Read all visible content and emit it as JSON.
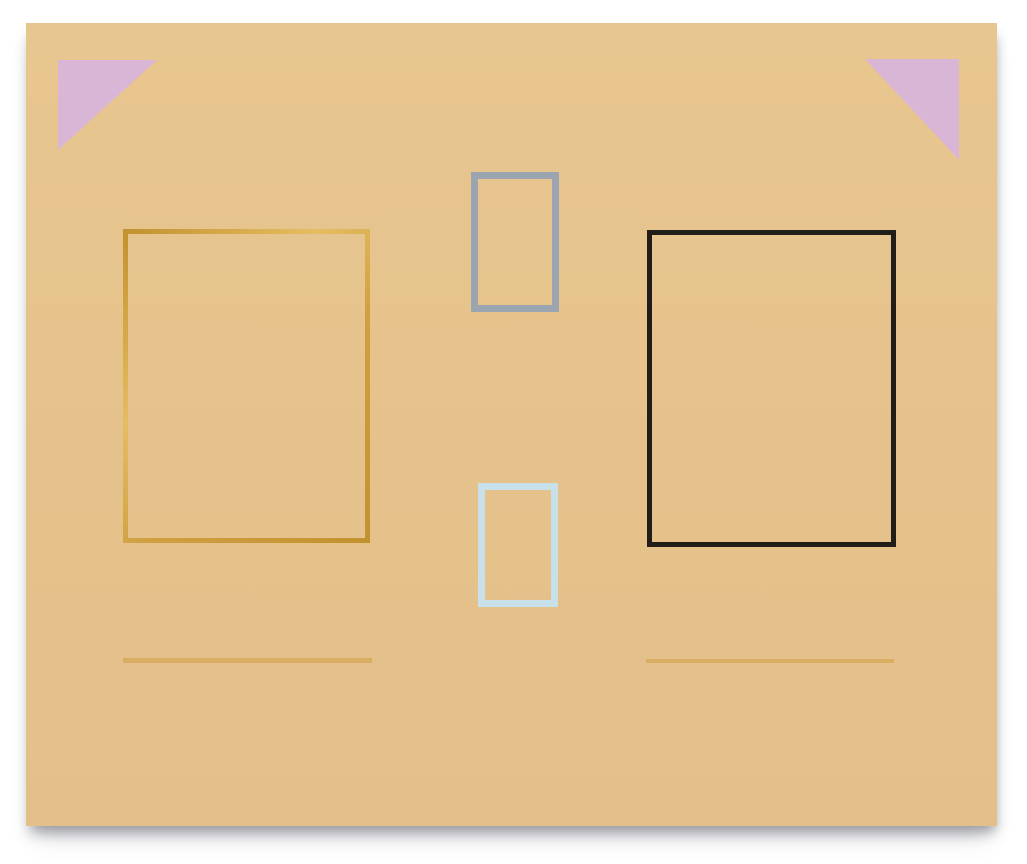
{
  "artwork": {
    "description": "Photograph of a minimalist abstract painting: tan canvas with two pink corner triangles, four rectangle outlines (gold, gray, black, light blue) and two faint gold horizontal lines near the bottom.",
    "palette": {
      "background_white": "#ffffff",
      "canvas_tan": "#e5c28b",
      "pink_lavender": "#d9b6d6",
      "gold": "#cfa04a",
      "black": "#211d18",
      "blue_gray": "#9ba5b0",
      "light_blue": "#c7e0e9",
      "faint_gold_line": "rgba(207,159,66,0.55)",
      "shadow_gray": "rgba(96,98,110,0.45)"
    },
    "shapes": [
      {
        "name": "corner-triangle-left",
        "kind": "triangle",
        "color": "#d9b6d6",
        "x": 32,
        "y": 37,
        "w": 99,
        "h": 90,
        "clip": "polygon(0 0, 100% 0, 0 100%)"
      },
      {
        "name": "corner-triangle-right",
        "kind": "triangle",
        "color": "#d9b6d6",
        "x": 839,
        "y": 36,
        "w": 94,
        "h": 101,
        "clip": "polygon(0 0, 100% 0, 100% 100%)"
      },
      {
        "name": "gold-frame-rectangle",
        "kind": "frame",
        "variant": "metallic",
        "color": "#cfa04a",
        "stroke": 5,
        "x": 97,
        "y": 206,
        "w": 247,
        "h": 314
      },
      {
        "name": "gray-frame-rectangle",
        "kind": "frame",
        "color": "#9ba5b0",
        "stroke": 7,
        "x": 445,
        "y": 149,
        "w": 88,
        "h": 140
      },
      {
        "name": "black-frame-rectangle",
        "kind": "frame",
        "color": "#211d18",
        "stroke": 5,
        "x": 621,
        "y": 207,
        "w": 249,
        "h": 317
      },
      {
        "name": "lightblue-frame-rectangle",
        "kind": "frame",
        "color": "#c7e0e9",
        "stroke": 7,
        "x": 452,
        "y": 460,
        "w": 80,
        "h": 124
      },
      {
        "name": "gold-underline-left",
        "kind": "underline",
        "color": "rgba(207,159,66,0.55)",
        "x": 97,
        "y": 635,
        "w": 249,
        "h": 5
      },
      {
        "name": "gold-underline-right",
        "kind": "underline",
        "color": "rgba(207,159,66,0.55)",
        "x": 620,
        "y": 636,
        "w": 248,
        "h": 4
      }
    ]
  }
}
